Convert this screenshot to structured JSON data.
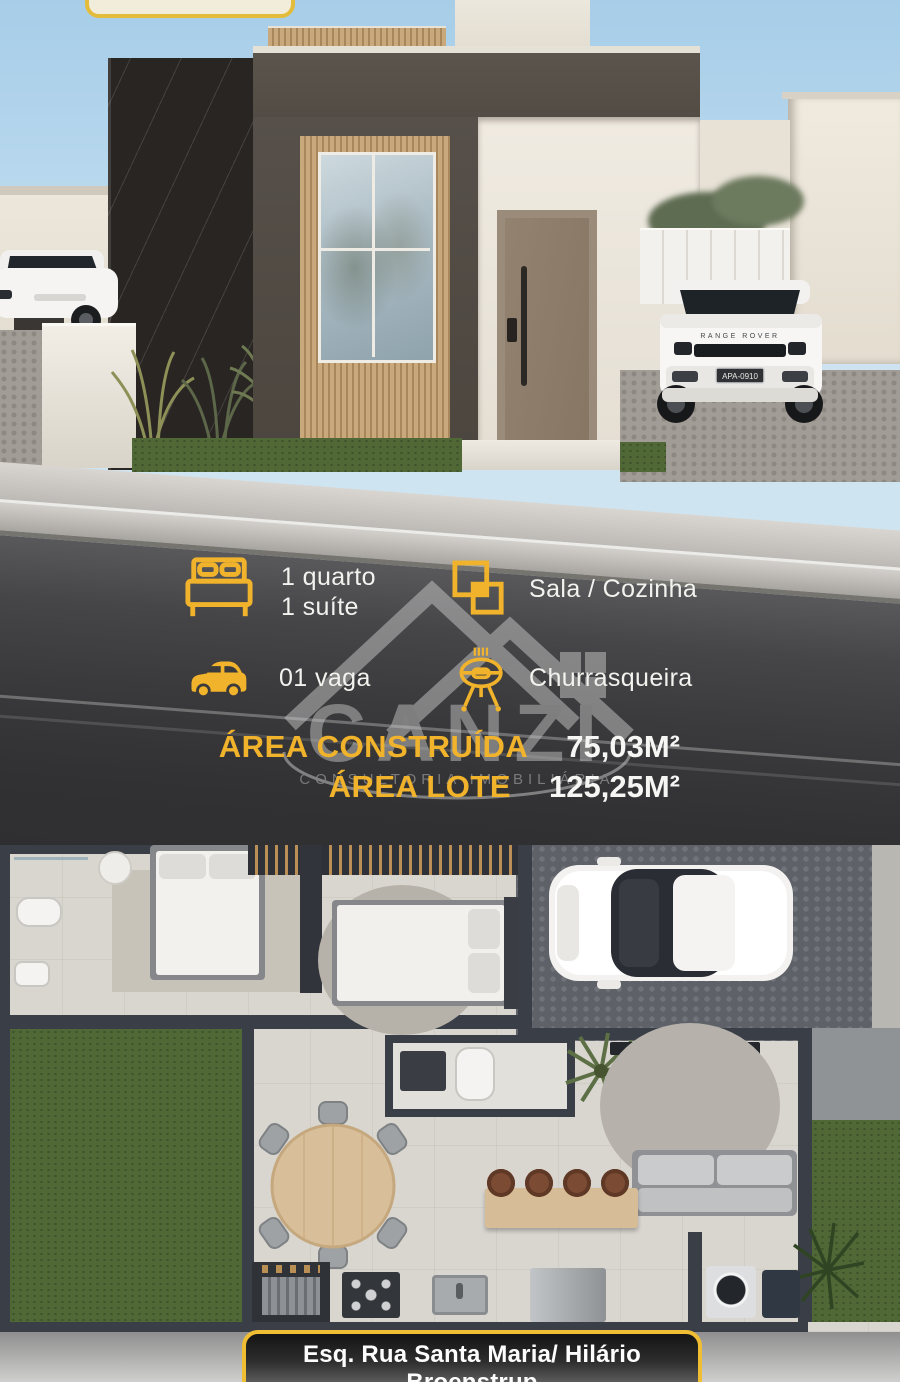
{
  "features": [
    {
      "icon": "bed-icon",
      "lines": [
        "1 quarto",
        "1 suíte"
      ]
    },
    {
      "icon": "overlapping-squares-icon",
      "lines": [
        "Sala / Cozinha"
      ]
    },
    {
      "icon": "car-icon",
      "lines": [
        "01 vaga"
      ]
    },
    {
      "icon": "barbecue-grill-icon",
      "lines": [
        "Churrasqueira"
      ]
    }
  ],
  "areas": {
    "built_label": "ÁREA CONSTRUÍDA",
    "built_value": "75,03M²",
    "lot_label": "ÁREA LOTE",
    "lot_value": "125,25M²"
  },
  "watermark": {
    "brand": "CANZI",
    "subtitle": "CONSULTORIA IMOBILIÁRIA"
  },
  "address": {
    "line1": "Esq. Rua Santa Maria/ Hilário Broenstrup",
    "line2": "Realeza - PR"
  },
  "vehicle": {
    "hood_badge": "RANGE ROVER",
    "license_plate": "APA-0910"
  },
  "colors": {
    "accent_yellow": "#F1B32B",
    "text_white": "#F4F4F2",
    "road_dark": "#37373A",
    "sky_blue": "#ACD1E9",
    "watermark_gray": "#C9C9C9",
    "plan_wall": "#3A3E46",
    "lawn_green": "#4F6836"
  }
}
